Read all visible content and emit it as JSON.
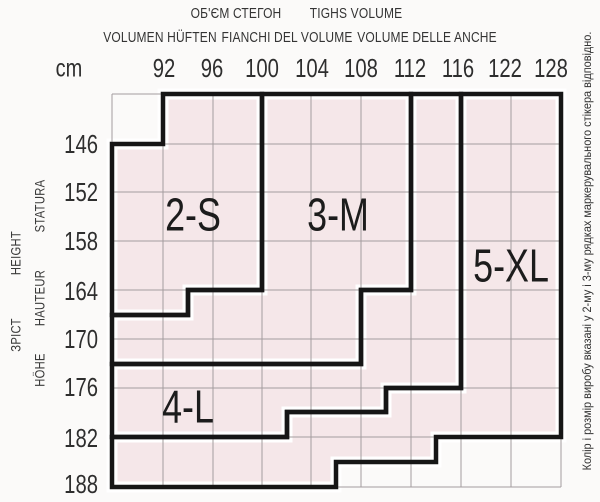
{
  "header": {
    "volume_uk": "ОБ'ЄМ СТЕГОН",
    "volume_en": "TIGHS VOLUME",
    "volume_de": "VOLUMEN HÜFTEN",
    "volume_it": "FIANCHI DEL VOLUME",
    "volume_it_anche": "VOLUME DELLE ANCHE",
    "unit": "cm"
  },
  "hips": [
    "92",
    "96",
    "100",
    "104",
    "108",
    "112",
    "116",
    "122",
    "128"
  ],
  "heights": [
    "146",
    "152",
    "158",
    "164",
    "170",
    "176",
    "182",
    "188"
  ],
  "stature_labels": {
    "statura": "STATURA",
    "height": "HEIGHT",
    "hauteur": "HAUTEUR",
    "zrist": "ЗРІСТ",
    "hohe": "HÖHE"
  },
  "regions": [
    {
      "id": "2-s",
      "label": "2-S"
    },
    {
      "id": "3-m",
      "label": "3-M"
    },
    {
      "id": "4-l",
      "label": "4-L"
    },
    {
      "id": "5-xl",
      "label": "5-XL"
    }
  ],
  "side_note": "Колір і розмір виробу вказані у 2-му і 3-му рядках маркерувального стікера відповідно.",
  "colors": {
    "region_fill": "#f5e7e9",
    "region_border": "#161616",
    "inset_gap": "#ffffff",
    "grid_line": "#a39c9e",
    "background": "#fbfaf9",
    "text": "#2a2a2a"
  },
  "chart_data": {
    "type": "size-lookup-grid",
    "x_axis": {
      "label": "cm",
      "values": [
        92,
        96,
        100,
        104,
        108,
        112,
        116,
        122,
        128
      ]
    },
    "y_axis": {
      "values": [
        146,
        152,
        158,
        164,
        170,
        176,
        182,
        188
      ]
    },
    "sizes": [
      "2-S",
      "3-M",
      "4-L",
      "5-XL"
    ]
  }
}
